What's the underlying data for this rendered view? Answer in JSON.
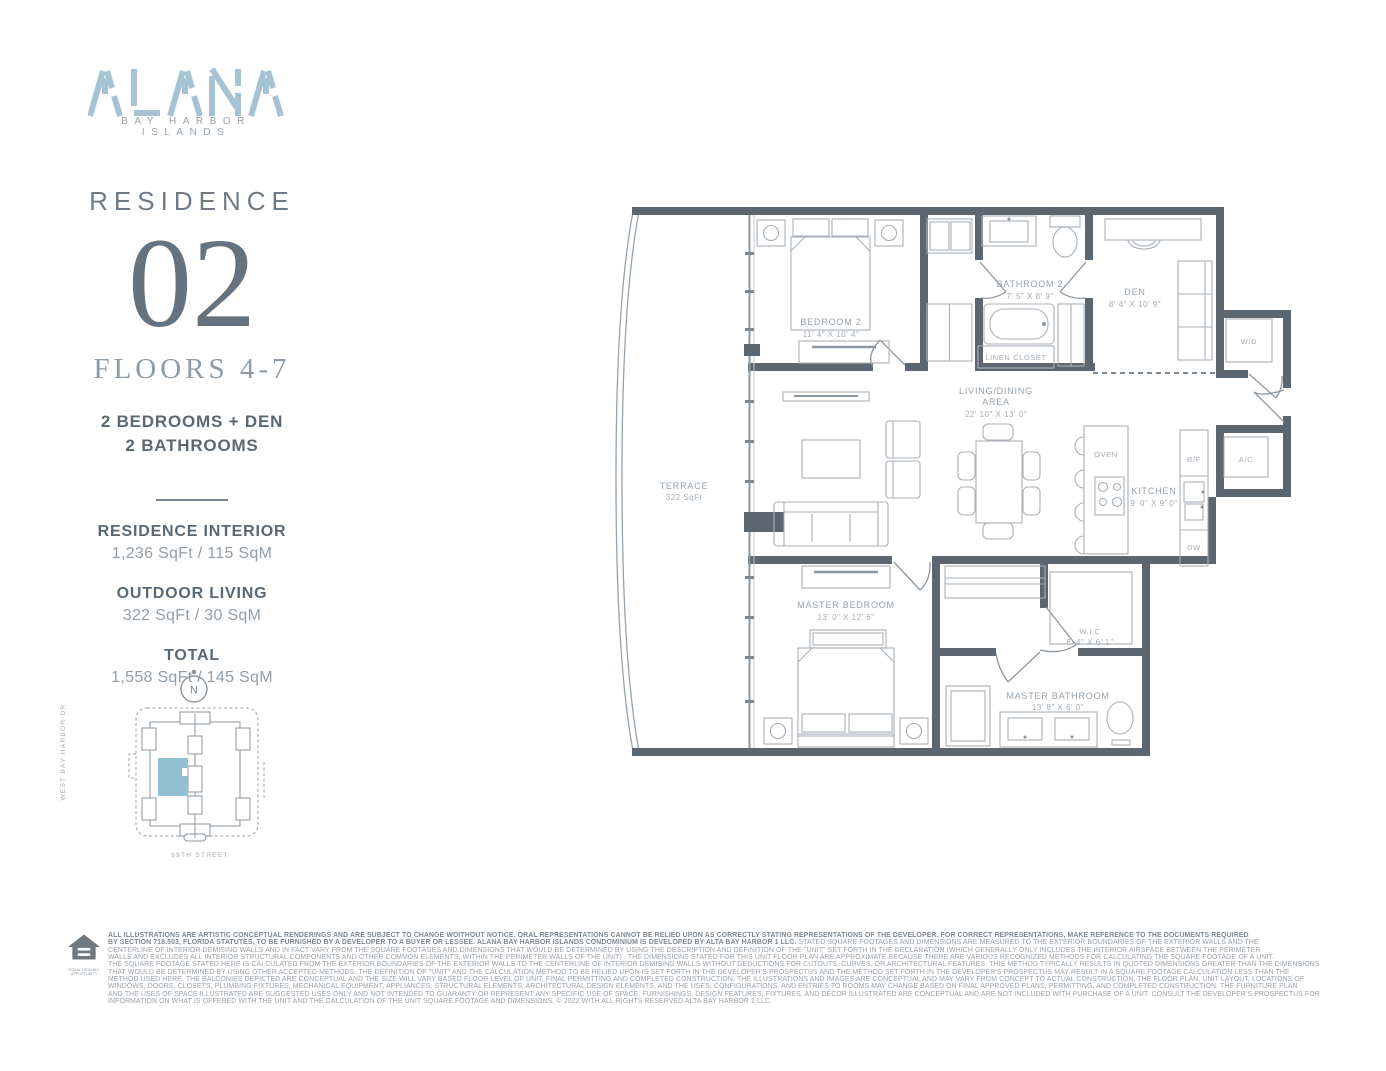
{
  "colors": {
    "accent_blue": "#a6c3d4",
    "wall": "#5b6671",
    "keyplan_highlight": "#92bfd2"
  },
  "brand": {
    "name": "ALANA",
    "tagline": "BAY HARBOR ISLANDS"
  },
  "residence": {
    "label": "RESIDENCE",
    "number": "02",
    "floors": "FLOORS 4-7",
    "config_line1": "2 BEDROOMS + DEN",
    "config_line2": "2 BATHROOMS"
  },
  "stats": [
    {
      "label": "RESIDENCE INTERIOR",
      "value": "1,236 SqFt / 115 SqM"
    },
    {
      "label": "OUTDOOR LIVING",
      "value": "322 SqFt / 30 SqM"
    },
    {
      "label": "TOTAL",
      "value": "1,558 SqFt / 145 SqM"
    }
  ],
  "keyplan": {
    "compass": "N",
    "street_left": "WEST BAY HARBOR DR",
    "street_bottom": "99TH STREET"
  },
  "floorplan": {
    "terrace": {
      "name": "TERRACE",
      "size": "322 SqFt"
    },
    "bedroom2": {
      "name": "BEDROOM 2",
      "dims": "11' 4\" X 10' 4\""
    },
    "bathroom2": {
      "name": "BATHROOM 2",
      "dims": "7' 5\" X 8' 9\""
    },
    "linen": {
      "name": "LINEN CLOSET"
    },
    "den": {
      "name": "DEN",
      "dims": "8' 4\" X 10' 9\""
    },
    "wd": {
      "name": "W/D"
    },
    "living": {
      "name1": "LIVING/DINING",
      "name2": "AREA",
      "dims": "22' 10\" X 13' 0\""
    },
    "oven": {
      "name": "OVEN"
    },
    "kitchen": {
      "name": "KITCHEN",
      "dims": "9' 0\" X 9' 0\""
    },
    "rf": {
      "name": "R/F"
    },
    "ac": {
      "name": "A/C"
    },
    "dw": {
      "name": "DW"
    },
    "master": {
      "name": "MASTER BEDROOM",
      "dims": "13' 0\" X 12' 6\""
    },
    "wic": {
      "name": "W.I.C",
      "dims": "6' 4\" X 6' 1\""
    },
    "masterbath": {
      "name": "MASTER BATHROOM",
      "dims": "13' 8\" X 6' 0\""
    }
  },
  "disclaimer": {
    "icon_caption": "EQUAL HOUSING OPPORTUNITY",
    "line1_bold": "ALL ILLUSTRATIONS ARE ARTISTIC CONCEPTUAL RENDERINGS AND ARE SUBJECT TO CHANGE WOITHOUT NOTICE. ORAL REPRESENTATIONS CANNOT BE RELIED UPON AS CORRECTLY STATING REPRESENTATIONS OF THE DEVELOPER. FOR CORRECT REPRESENTATIONS, MAKE REFERENCE TO THE DOCUMENTS REQUIRED",
    "line2_bold": "BY SECTION 718.503, FLORIDA STATUTES, TO BE FURNISHED BY A DEVELOPER TO A BUYER OR LESSEE. ALANA BAY HARBOR ISLANDS CONDOMINIUM IS DEVELOPED BY  ALTA BAY HARBOR 1 LLC.",
    "line2_rest": " STATED SQUARE FOOTAGES AND DIMENSIONS ARE MEASURED TO THE EXTERIOR BOUNDARIES OF THE EXTERIOR WALLS AND THE",
    "rest": [
      "CENTERLINE OF INTERIOR DEMISING WALLS AND IN FACT VARY FROM THE SQUARE FOOTAGES AND DIMENSIONS THAT WOULD BE DETERMINED BY USING THE DESCRIPTION AND DEFINITION OF THE \"UNIT\" SET FORTH IN THE DECLARATION (WHICH GENERALLY ONLY INCLUDES THE INTERIOR AIRSPACE BETWEEN THE PERIMETER",
      "WALLS AND EXCLUDES ALL INTERIOR STRUCTURAL COMPONENTS AND OTHER COMMON ELEMENTS, WITHIN THE PERIMETER WALLS OF THE UNIT) . THE DIMENSIONS STATED FOR THIS UNIT FLOOR PLAN ARE APPROXIMATE BECAUSE THERE ARE VARIOUS RECOGNIZED METHODS FOR CALCULATING THE SQUARE FOOTAGE OF A UNIT.",
      "THE SQUARE FOOTAGE STATED HERE IS CALCULATED FROM THE EXTERIOR BOUNDARIES OF THE EXTERIOR WALLS TO THE CENTERLINE OF INTERIOR DEMISING WALLS WITHOUT DEDUCTIONS FOR CUTOUTS, CURVES, OR ARCHITECTURAL FEATURES. THIS METHOD TYPICALLY RESULTS IN QUOTED DIMENSIONS GREATER THAN THE DIMENSIONS",
      "THAT WOULD BE DETERMINED BY USING OTHER ACCEPTED METHODS. THE DEFINITION OF \"UNIT\" AND THE CALCULATION METHOD TO BE RELIED UPON IS SET FORTH IN THE DEVELOPER'S PROSPECTUS AND THE METHOD SET FORTH IN THE DEVELOPER'S PROSPECTUS MAY RESULT IN A SQUARE FOOTAGE CALCULATION LESS THAN THE",
      "METHOD USED HERE. THE BALCONIES DEPICTED ARE CONCEPTUAL AND THE SIZE WILL VARY BASED FLOOR LEVEL OF UNIT, FINAL PERMITTING AND COMPLETED CONSTRUCTION. THE ILLUSTRATIONS AND IMAGES ARE CONCEPTUAL AND MAY VARY FROM CONCEPT TO ACTUAL CONSTRUCTION. THE FLOOR PLAN, UNIT LAYOUT, LOCATIONS OF",
      "WINDOWS, DOORS, CLOSETS, PLUMBING FIXTURES, MECHANICAL EQUIPMENT, APPLIANCES, STRUCTURAL ELEMENTS, ARCHITECTURAL DESIGN ELEMENTS, AND THE USES, CONFIGURATIONS, AND ENTRIES TO ROOMS MAY CHANGE BASED ON FINAL APPROVED PLANS, PERMITTING, AND COMPLETED CONSTRUCTION. THE FURNITURE PLAN",
      "AND THE USES OF SPACE ILLUSTRATED ARE SUGGESTED USES ONLY AND NOT INTENDED TO GUARANTY OR REPRESENT ANY SPECIFIC USE OF SPACE. FURNISHINGS, DESIGN FEATURES, FIXTURES, AND DÉCOR ILLUSTRATED ARE CONCEPTUAL AND ARE NOT INCLUDED WITH PURCHASE OF A UNIT. CONSULT THE DEVELOPER'S PROSPECTUS FOR",
      "INFORMATION ON WHAT IS OFFERED WITH THE UNIT AND THE CALCULATION OF THE UNIT SQUARE FOOTAGE AND DIMENSIONS. © 2022 WITH ALL RIGHTS RESERVED ALTA BAY HARBOR 1 LLC."
    ]
  }
}
